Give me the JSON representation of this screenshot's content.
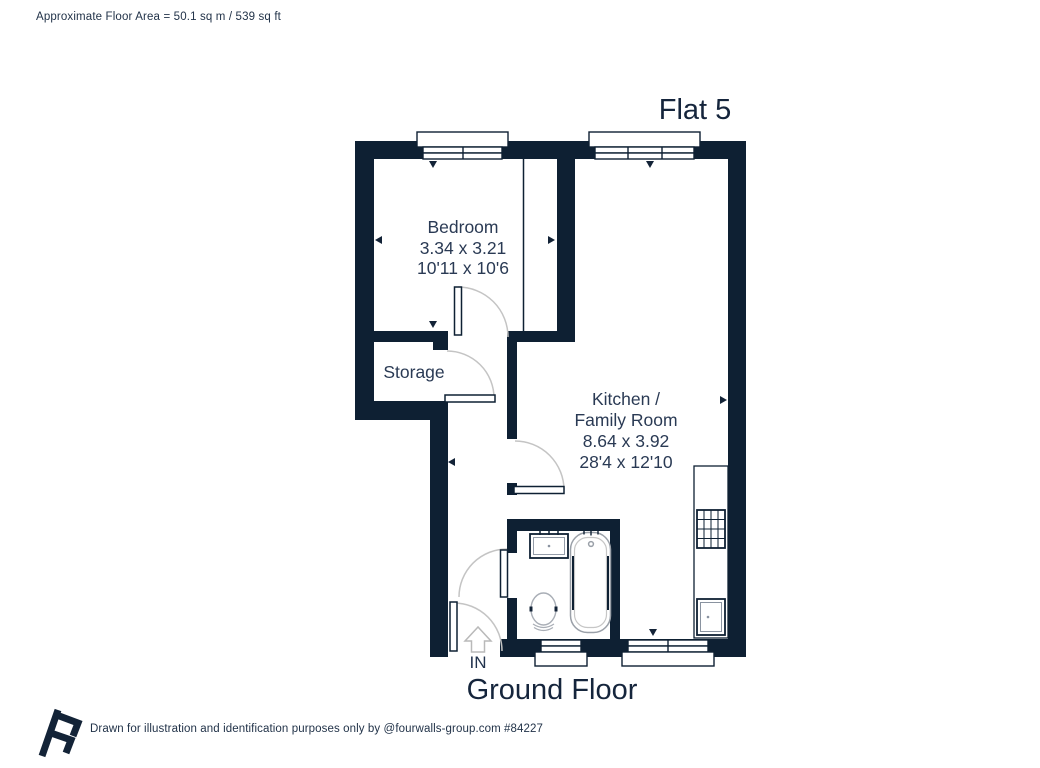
{
  "header": {
    "floor_area_label": "Approximate Floor Area = 50.1 sq m / 539 sq ft"
  },
  "plan": {
    "title": "Flat 5",
    "floor_label": "Ground Floor",
    "entry_label": "IN",
    "rooms": {
      "bedroom": {
        "name": "Bedroom",
        "size_metric": "3.34 x 3.21",
        "size_imperial": "10'11 x 10'6"
      },
      "storage": {
        "name": "Storage"
      },
      "kitchen_family": {
        "line1": "Kitchen /",
        "line2": "Family Room",
        "size_metric": "8.64 x 3.92",
        "size_imperial": "28'4 x 12'10"
      }
    },
    "fixtures": [
      "bathtub",
      "toilet",
      "basin",
      "hob",
      "kitchen-sink",
      "counter"
    ],
    "colors": {
      "wall": "#0e2033",
      "text": "#2a3a54",
      "door_arc": "#c4c4c4",
      "fixture_gray": "#9aa0a8"
    }
  },
  "footer": {
    "credit": "Drawn for illustration and identification purposes only by @fourwalls-group.com #84227"
  }
}
